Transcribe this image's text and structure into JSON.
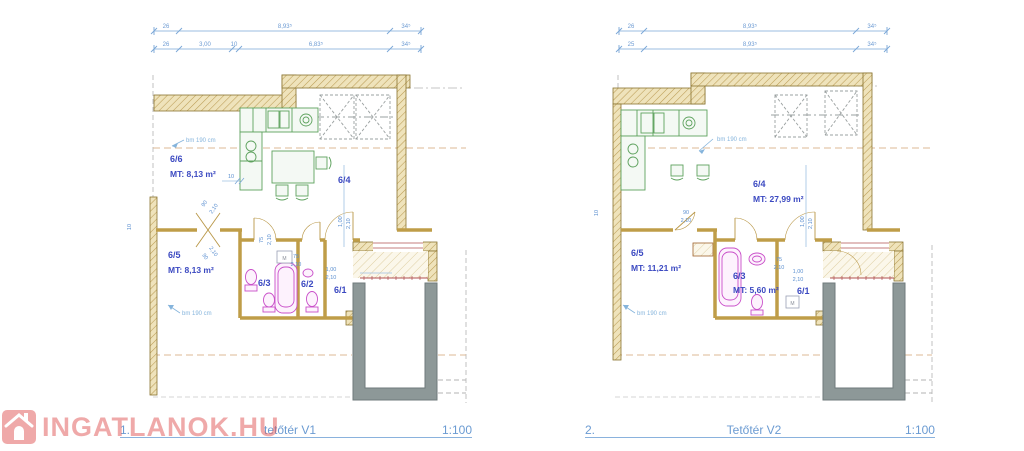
{
  "watermark": {
    "text": "INGATLANOK.HU",
    "icon": "house-icon",
    "color": "#e05555"
  },
  "shared": {
    "bm_label": "bm 190 cm",
    "machine_label": "M"
  },
  "colors": {
    "dimension_blue": "#6d9bd3",
    "room_label_blue": "#3b49c1",
    "wall_tan": "#c9a855",
    "furniture_green": "#5ea25e",
    "fixture_magenta": "#c94fc9",
    "balcony_gray": "#8d9898",
    "roof_dash_tan": "#dcb894",
    "stair_red": "#b05050",
    "title_blue": "#6b9bd2"
  },
  "plans": [
    {
      "number": "1.",
      "title": "tetőtér V1",
      "scale": "1:100",
      "dims_row1": [
        "26",
        "8,93⁵",
        "34⁵"
      ],
      "dims_row2": [
        "26",
        "3,00",
        "10",
        "6,83⁵",
        "34⁵"
      ],
      "dim_side": "10",
      "dim_kitchen": "10",
      "rooms": [
        {
          "name": "6/6",
          "area": "MT: 8,13 m²"
        },
        {
          "name": "6/5",
          "area": "MT: 8,13 m²"
        }
      ],
      "room_marks": [
        "6/4",
        "6/3",
        "6/2",
        "6/1"
      ],
      "door_dims": {
        "diag_upper": [
          "90",
          "2,10"
        ],
        "diag_lower": [
          "90",
          "2,10"
        ],
        "d75_rot": [
          "75",
          "2,10"
        ],
        "d75": [
          "75",
          "2,10"
        ],
        "d100": [
          "1,00",
          "2,10"
        ],
        "d100_rot": [
          "1,00",
          "2,10"
        ]
      }
    },
    {
      "number": "2.",
      "title": "Tetőtér V2",
      "scale": "1:100",
      "dims_row1": [
        "26",
        "8,93⁵",
        "34⁵"
      ],
      "dims_row2": [
        "25",
        "8,93⁵",
        "34⁵"
      ],
      "dim_side": "10",
      "rooms": [
        {
          "name": "6/4",
          "area": "MT: 27,99 m²"
        },
        {
          "name": "6/5",
          "area": "MT: 11,21 m²"
        },
        {
          "name": "6/3",
          "area": "MT: 5,60 m²"
        }
      ],
      "room_marks": [
        "6/1"
      ],
      "door_dims": {
        "d90": [
          "90",
          "2,10"
        ],
        "d75": [
          "75",
          "2,10"
        ],
        "d100": [
          "1,00",
          "2,10"
        ],
        "d100_rot": [
          "1,00",
          "2,10"
        ]
      }
    }
  ]
}
